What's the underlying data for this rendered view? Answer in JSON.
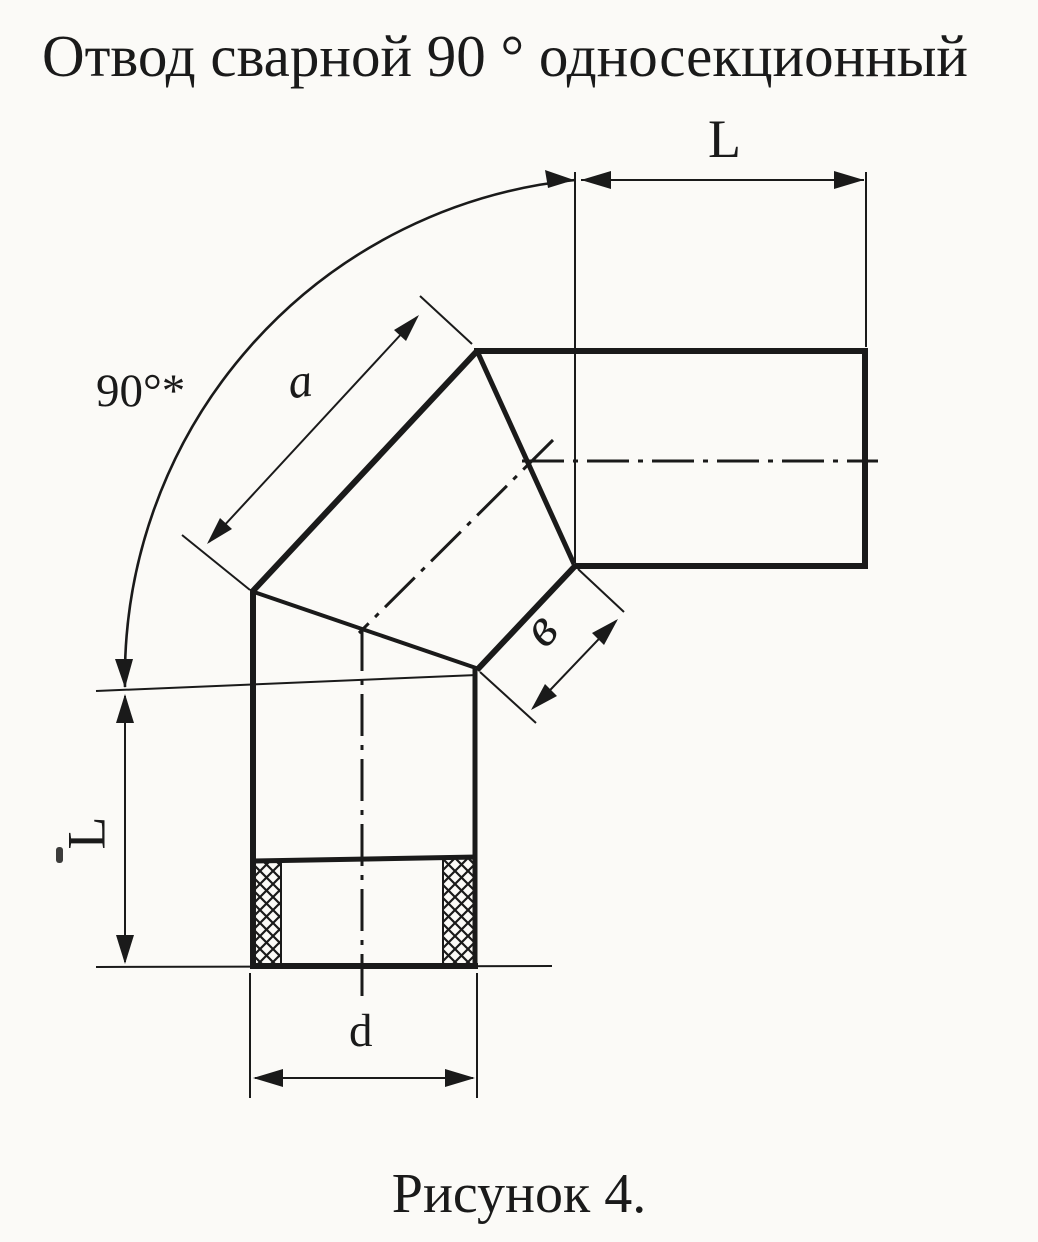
{
  "title": "Отвод сварной 90 ° односекционный",
  "caption": "Рисунок 4.",
  "dimensions": {
    "top_length_label": "L",
    "left_length_label": "L",
    "diameter_label": "d",
    "segment_length_label": "a",
    "seam_width_label": "в",
    "angle_label": "90°*"
  },
  "colors": {
    "ink": "#1a1a1a",
    "paper": "#fbfaf7"
  }
}
